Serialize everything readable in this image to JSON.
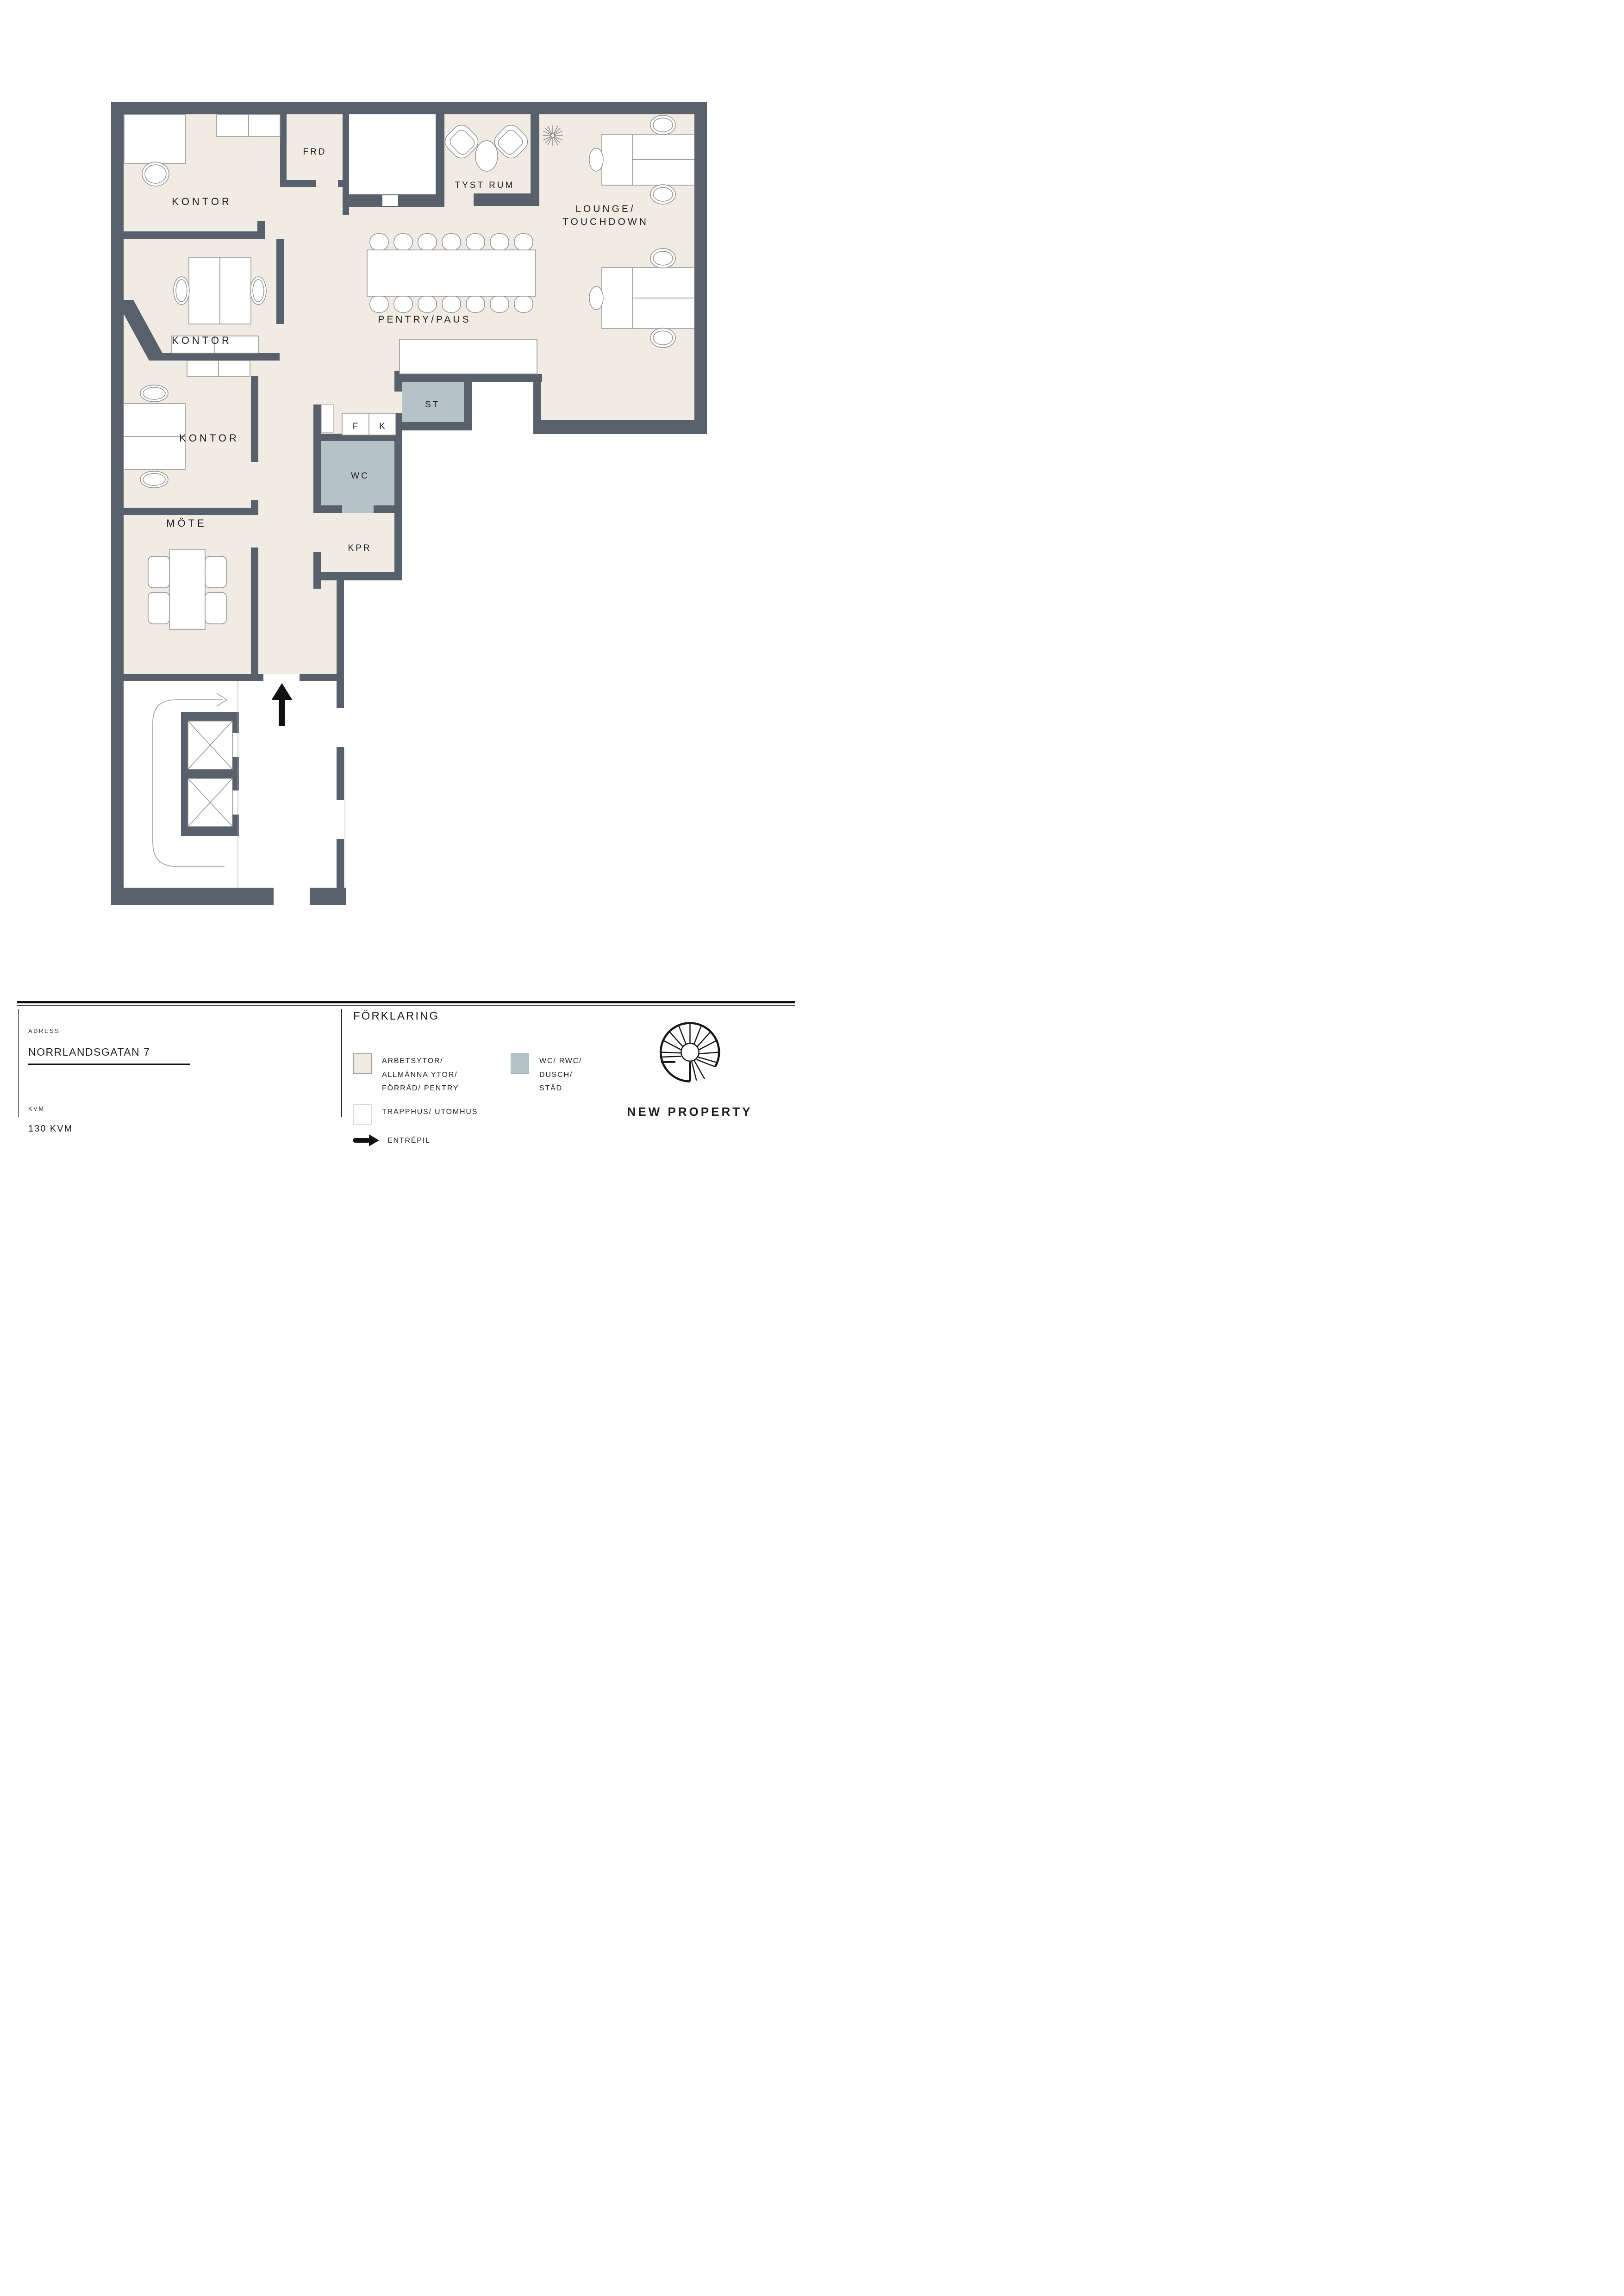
{
  "floorplan": {
    "labels": {
      "kontor_1": "KONTOR",
      "kontor_2": "KONTOR",
      "kontor_3": "KONTOR",
      "frd": "FRD",
      "tyst_rum": "TYST RUM",
      "lounge_line1": "LOUNGE/",
      "lounge_line2": "TOUCHDOWN",
      "pentry_paus": "PENTRY/PAUS",
      "st": "ST",
      "f": "F",
      "k": "K",
      "wc": "WC",
      "kpr": "KPR",
      "mote": "MÖTE"
    }
  },
  "info": {
    "adress_label": "ADRESS",
    "adress_value": "NORRLANDSGATAN 7",
    "kvm_label": "KVM",
    "kvm_value": "130 KVM"
  },
  "legend": {
    "title": "FÖRKLARING",
    "items": [
      {
        "swatch": "#F1ECE3",
        "label_line1": "ARBETSYTOR/ ALLMÄNNA YTOR/",
        "label_line2": "FÖRRÅD/ PENTRY"
      },
      {
        "swatch": "#B5C3C9",
        "label_line1": "WC/ RWC/ DUSCH/",
        "label_line2": "STÄD"
      },
      {
        "swatch": "#FFFFFF",
        "label_line1": "TRAPPHUS/ UTOMHUS"
      },
      {
        "swatch": "arrow",
        "label": "ENTRÉPIL"
      }
    ]
  },
  "brand": {
    "name": "NEW PROPERTY"
  },
  "colors": {
    "wall": "#57606B",
    "work_area": "#F1ECE3",
    "wet_area": "#B5C3C9",
    "stair_area": "#FFFFFF",
    "entry_arrow": "#111111"
  }
}
